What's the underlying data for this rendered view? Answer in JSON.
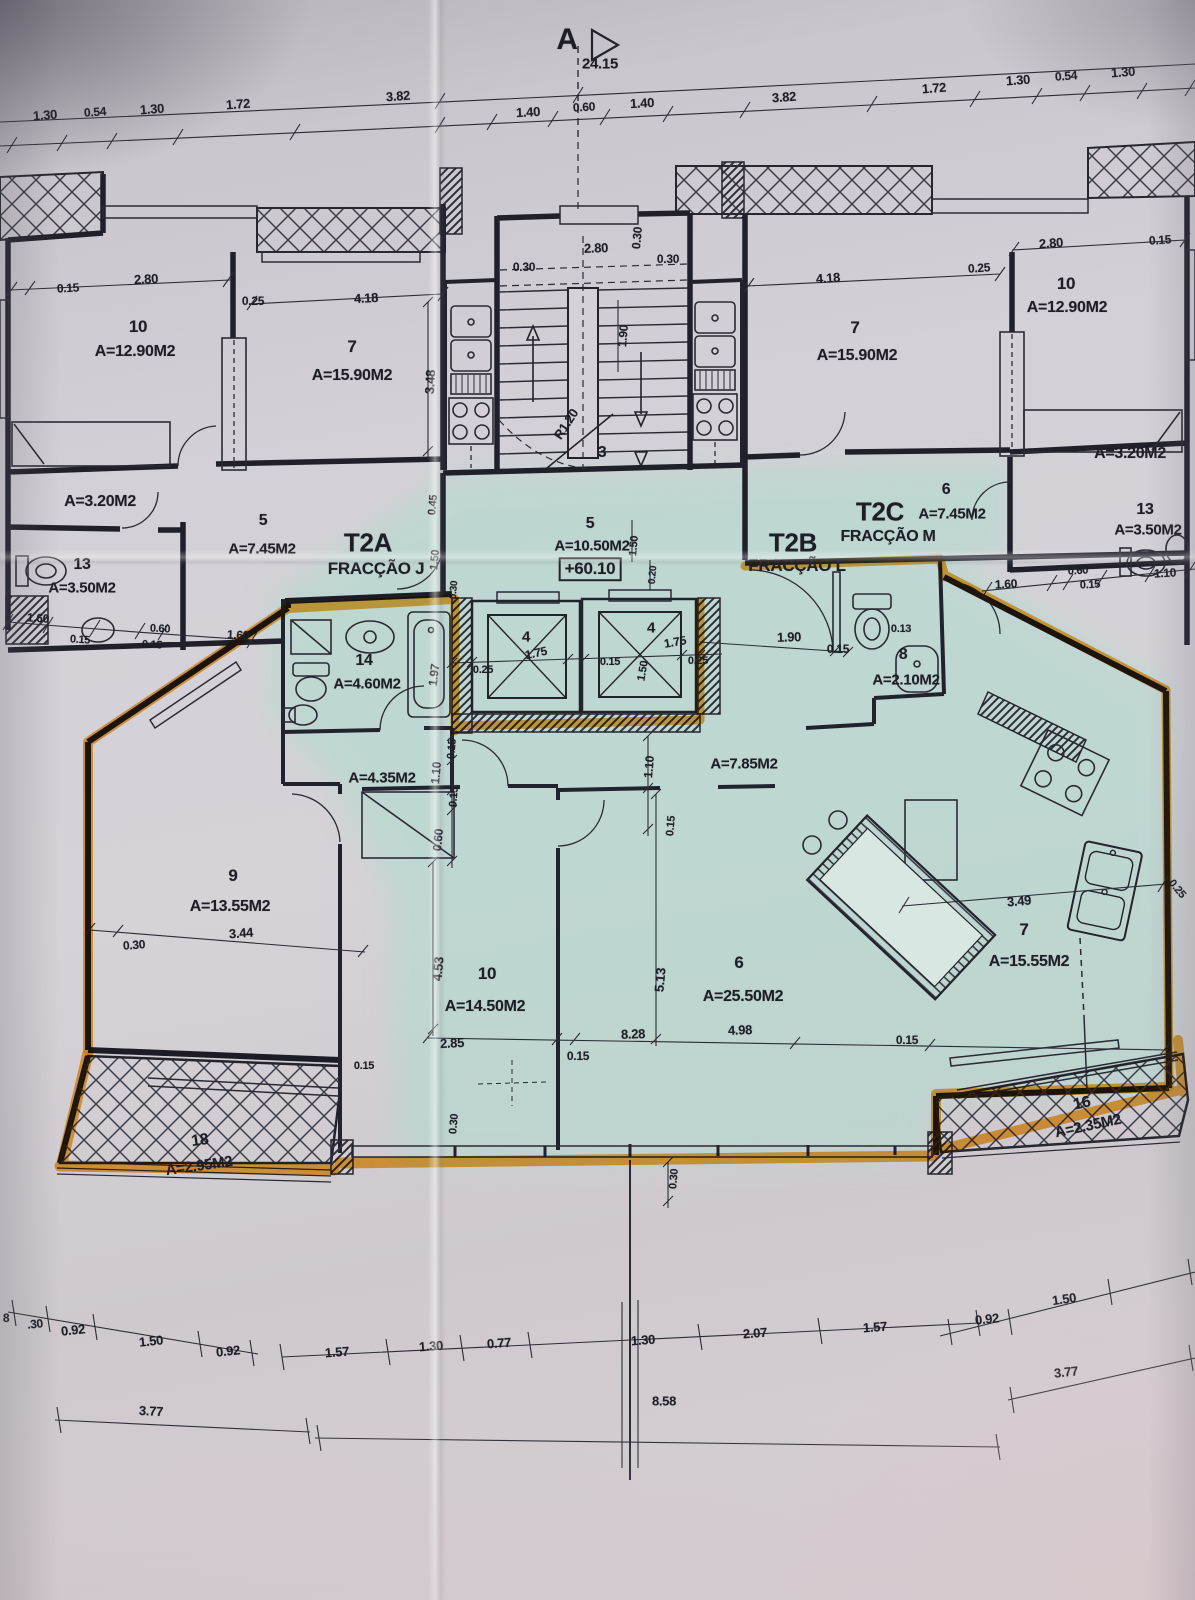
{
  "document": {
    "type": "architectural floor plan photo",
    "section_marker": "A",
    "section_overall_dim": "24.15",
    "floor_elevation": "+60.10",
    "stair_radius_note": "R1.20",
    "stair_room_number": "3"
  },
  "units": [
    {
      "code": "T2A",
      "fraction": "FRACÇÃO J",
      "highlighted": false
    },
    {
      "code": "T2B",
      "fraction": "FRACÇÃO L",
      "highlighted": true
    },
    {
      "code": "T2C",
      "fraction": "FRACÇÃO M",
      "highlighted": false
    }
  ],
  "colors": {
    "paper": "#d3d0d7",
    "highlight_tint": "#aedcce",
    "marker_orange": "#f59d16",
    "ink": "#1e1e27"
  },
  "labels": [
    {
      "n": "section-letter",
      "t": "A",
      "x": 567,
      "y": 40,
      "s": 30,
      "w": 700
    },
    {
      "n": "dim-label",
      "t": "24.15",
      "x": 600,
      "y": 64,
      "s": 15
    },
    {
      "n": "dim-label",
      "t": "1.30",
      "x": 45,
      "y": 115,
      "r": -4
    },
    {
      "n": "dim-label",
      "t": "0.54",
      "x": 95,
      "y": 112,
      "r": -4,
      "s": 12
    },
    {
      "n": "dim-label",
      "t": "1.30",
      "x": 152,
      "y": 109,
      "r": -4
    },
    {
      "n": "dim-label",
      "t": "1.72",
      "x": 238,
      "y": 104,
      "r": -4
    },
    {
      "n": "dim-label",
      "t": "3.82",
      "x": 398,
      "y": 96,
      "r": -4
    },
    {
      "n": "dim-label",
      "t": "1.40",
      "x": 528,
      "y": 112,
      "r": -3
    },
    {
      "n": "dim-label",
      "t": "0.60",
      "x": 584,
      "y": 107,
      "r": -3,
      "s": 12
    },
    {
      "n": "dim-label",
      "t": "1.40",
      "x": 642,
      "y": 103,
      "r": -3
    },
    {
      "n": "dim-label",
      "t": "3.82",
      "x": 784,
      "y": 97,
      "r": -4
    },
    {
      "n": "dim-label",
      "t": "1.72",
      "x": 934,
      "y": 88,
      "r": -4
    },
    {
      "n": "dim-label",
      "t": "1.30",
      "x": 1018,
      "y": 80,
      "r": -4
    },
    {
      "n": "dim-label",
      "t": "0.54",
      "x": 1066,
      "y": 76,
      "r": -4,
      "s": 12
    },
    {
      "n": "dim-label",
      "t": "1.30",
      "x": 1123,
      "y": 72,
      "r": -4
    },
    {
      "n": "dim-label",
      "t": "0.15",
      "x": 68,
      "y": 288,
      "r": -3,
      "s": 12
    },
    {
      "n": "dim-label",
      "t": "2.80",
      "x": 146,
      "y": 279,
      "r": -3
    },
    {
      "n": "room-number",
      "t": "10",
      "x": 138,
      "y": 327,
      "s": 17
    },
    {
      "n": "room-area",
      "t": "A=12.90M2",
      "x": 135,
      "y": 352,
      "s": 16
    },
    {
      "n": "dim-label",
      "t": "0.25",
      "x": 253,
      "y": 301,
      "s": 12
    },
    {
      "n": "dim-label",
      "t": "4.18",
      "x": 366,
      "y": 298,
      "r": -3
    },
    {
      "n": "room-number",
      "t": "7",
      "x": 352,
      "y": 347,
      "s": 17
    },
    {
      "n": "room-area",
      "t": "A=15.90M2",
      "x": 352,
      "y": 376,
      "s": 16
    },
    {
      "n": "dim-label",
      "t": "3.48",
      "x": 430,
      "y": 382,
      "r": -87
    },
    {
      "n": "dim-label",
      "t": "2.80",
      "x": 596,
      "y": 248,
      "r": -2
    },
    {
      "n": "dim-label",
      "t": "0.30",
      "x": 524,
      "y": 267,
      "s": 12
    },
    {
      "n": "dim-label",
      "t": "0.30",
      "x": 668,
      "y": 259,
      "s": 12
    },
    {
      "n": "dim-label",
      "t": "0.30",
      "x": 637,
      "y": 238,
      "r": -85,
      "s": 12
    },
    {
      "n": "dim-label",
      "t": "1.90",
      "x": 623,
      "y": 336,
      "r": -85,
      "s": 12
    },
    {
      "n": "stair-radius",
      "t": "R1.20",
      "x": 566,
      "y": 424,
      "r": -57,
      "s": 13
    },
    {
      "n": "stair-number",
      "t": "3",
      "x": 602,
      "y": 453,
      "s": 16
    },
    {
      "n": "dim-label",
      "t": "4.18",
      "x": 828,
      "y": 278,
      "r": -4
    },
    {
      "n": "room-number",
      "t": "7",
      "x": 855,
      "y": 328,
      "s": 17
    },
    {
      "n": "room-area",
      "t": "A=15.90M2",
      "x": 857,
      "y": 356,
      "s": 16
    },
    {
      "n": "dim-label",
      "t": "0.25",
      "x": 979,
      "y": 268,
      "r": -4,
      "s": 12
    },
    {
      "n": "dim-label",
      "t": "2.80",
      "x": 1051,
      "y": 243,
      "r": -4
    },
    {
      "n": "room-number",
      "t": "10",
      "x": 1066,
      "y": 284,
      "s": 17
    },
    {
      "n": "room-area",
      "t": "A=12.90M2",
      "x": 1067,
      "y": 308,
      "s": 16
    },
    {
      "n": "dim-label",
      "t": "0.15",
      "x": 1160,
      "y": 240,
      "r": -4,
      "s": 12
    },
    {
      "n": "room-area",
      "t": "A=3.20M2",
      "x": 100,
      "y": 502,
      "s": 16
    },
    {
      "n": "room-number",
      "t": "5",
      "x": 263,
      "y": 521,
      "s": 16
    },
    {
      "n": "room-area",
      "t": "A=7.45M2",
      "x": 262,
      "y": 549,
      "s": 15
    },
    {
      "n": "room-number",
      "t": "13",
      "x": 82,
      "y": 565,
      "s": 16
    },
    {
      "n": "room-area",
      "t": "A=3.50M2",
      "x": 82,
      "y": 588,
      "s": 15
    },
    {
      "n": "dim-label",
      "t": "1.60",
      "x": 38,
      "y": 618,
      "r": 4,
      "s": 12
    },
    {
      "n": "dim-label",
      "t": "0.15",
      "x": 80,
      "y": 640,
      "r": 4,
      "s": 11
    },
    {
      "n": "dim-label",
      "t": "0.60",
      "x": 160,
      "y": 629,
      "r": 3,
      "s": 11
    },
    {
      "n": "dim-label",
      "t": "0.15",
      "x": 152,
      "y": 645,
      "r": 3,
      "s": 11
    },
    {
      "n": "dim-label",
      "t": "1.60",
      "x": 238,
      "y": 635,
      "r": 3,
      "s": 12
    },
    {
      "n": "unit-code-t2a",
      "t": "T2A",
      "x": 368,
      "y": 543,
      "s": 26,
      "w": 700
    },
    {
      "n": "unit-fraction-j",
      "t": "FRACÇÃO J",
      "x": 376,
      "y": 569,
      "s": 17
    },
    {
      "n": "dim-label",
      "t": "0.45",
      "x": 433,
      "y": 505,
      "r": -85,
      "s": 11
    },
    {
      "n": "dim-label",
      "t": "1.50",
      "x": 435,
      "y": 560,
      "r": -85,
      "s": 11
    },
    {
      "n": "dim-label",
      "t": "0.30",
      "x": 454,
      "y": 590,
      "r": -85,
      "s": 10
    },
    {
      "n": "room-number",
      "t": "5",
      "x": 590,
      "y": 524,
      "s": 16
    },
    {
      "n": "room-area",
      "t": "A=10.50M2",
      "x": 592,
      "y": 546,
      "s": 15
    },
    {
      "n": "elevation-label",
      "t": "+60.10",
      "x": 590,
      "y": 569,
      "s": 17,
      "w": 700,
      "box": true
    },
    {
      "n": "dim-label",
      "t": "1.50",
      "x": 634,
      "y": 546,
      "r": -85,
      "s": 11
    },
    {
      "n": "dim-label",
      "t": "0.20",
      "x": 653,
      "y": 575,
      "r": -85,
      "s": 10
    },
    {
      "n": "unit-code-t2b",
      "t": "T2B",
      "x": 793,
      "y": 543,
      "s": 26,
      "w": 700
    },
    {
      "n": "unit-fraction-l",
      "t": "FRACÇÃO L",
      "x": 797,
      "y": 566,
      "s": 17
    },
    {
      "n": "unit-code-t2c",
      "t": "T2C",
      "x": 880,
      "y": 512,
      "s": 26,
      "w": 700
    },
    {
      "n": "unit-fraction-m",
      "t": "FRACÇÃO M",
      "x": 888,
      "y": 537,
      "s": 16
    },
    {
      "n": "room-number",
      "t": "6",
      "x": 946,
      "y": 490,
      "s": 16
    },
    {
      "n": "room-area",
      "t": "A=7.45M2",
      "x": 952,
      "y": 514,
      "s": 15
    },
    {
      "n": "room-area",
      "t": "A=3.20M2",
      "x": 1130,
      "y": 454,
      "s": 16
    },
    {
      "n": "room-number",
      "t": "13",
      "x": 1145,
      "y": 510,
      "s": 16
    },
    {
      "n": "room-area",
      "t": "A=3.50M2",
      "x": 1148,
      "y": 530,
      "s": 15
    },
    {
      "n": "dim-label",
      "t": "1.60",
      "x": 1006,
      "y": 584,
      "r": -3,
      "s": 12
    },
    {
      "n": "dim-label",
      "t": "0.60",
      "x": 1078,
      "y": 571,
      "r": -3,
      "s": 11
    },
    {
      "n": "dim-label",
      "t": "0.15",
      "x": 1090,
      "y": 585,
      "r": -3,
      "s": 11
    },
    {
      "n": "dim-label",
      "t": "1.10",
      "x": 1165,
      "y": 573,
      "r": -3,
      "s": 12
    },
    {
      "n": "elevator-number",
      "t": "4",
      "x": 526,
      "y": 637,
      "s": 15
    },
    {
      "n": "dim-label",
      "t": "1.75",
      "x": 536,
      "y": 653,
      "r": -12,
      "s": 12
    },
    {
      "n": "dim-label",
      "t": "0.25",
      "x": 483,
      "y": 670,
      "s": 11
    },
    {
      "n": "elevator-number",
      "t": "4",
      "x": 651,
      "y": 628,
      "s": 15
    },
    {
      "n": "dim-label",
      "t": "1.75",
      "x": 675,
      "y": 642,
      "r": -10,
      "s": 12
    },
    {
      "n": "dim-label",
      "t": "0.15",
      "x": 610,
      "y": 662,
      "s": 11
    },
    {
      "n": "dim-label",
      "t": "1.50",
      "x": 643,
      "y": 671,
      "r": -80,
      "s": 11
    },
    {
      "n": "dim-label",
      "t": "0.25",
      "x": 698,
      "y": 661,
      "s": 11
    },
    {
      "n": "room-number",
      "t": "14",
      "x": 364,
      "y": 661,
      "s": 16
    },
    {
      "n": "room-area",
      "t": "A=4.60M2",
      "x": 367,
      "y": 684,
      "s": 15
    },
    {
      "n": "dim-label",
      "t": "1.97",
      "x": 434,
      "y": 675,
      "r": -83,
      "s": 12
    },
    {
      "n": "dim-label",
      "t": "1.90",
      "x": 789,
      "y": 637,
      "r": -2,
      "s": 13
    },
    {
      "n": "dim-label",
      "t": "0.15",
      "x": 838,
      "y": 649,
      "s": 12
    },
    {
      "n": "dim-label",
      "t": "0.13",
      "x": 901,
      "y": 629,
      "s": 11
    },
    {
      "n": "room-number",
      "t": "8",
      "x": 903,
      "y": 655,
      "s": 16
    },
    {
      "n": "room-area",
      "t": "A=2.10M2",
      "x": 906,
      "y": 680,
      "s": 15
    },
    {
      "n": "room-area",
      "t": "A=4.35M2",
      "x": 382,
      "y": 778,
      "s": 15
    },
    {
      "n": "dim-label",
      "t": "0.15",
      "x": 452,
      "y": 749,
      "r": -85,
      "s": 11
    },
    {
      "n": "dim-label",
      "t": "1.10",
      "x": 436,
      "y": 773,
      "r": -85,
      "s": 12
    },
    {
      "n": "dim-label",
      "t": "0.15",
      "x": 454,
      "y": 797,
      "r": -85,
      "s": 11
    },
    {
      "n": "dim-label",
      "t": "0.60",
      "x": 438,
      "y": 840,
      "r": -85,
      "s": 12
    },
    {
      "n": "dim-label",
      "t": "1.10",
      "x": 649,
      "y": 767,
      "r": -85,
      "s": 12
    },
    {
      "n": "room-area",
      "t": "A=7.85M2",
      "x": 744,
      "y": 764,
      "s": 15
    },
    {
      "n": "dim-label",
      "t": "0.15",
      "x": 671,
      "y": 826,
      "r": -85,
      "s": 11
    },
    {
      "n": "room-number",
      "t": "9",
      "x": 233,
      "y": 876,
      "s": 17
    },
    {
      "n": "room-area",
      "t": "A=13.55M2",
      "x": 230,
      "y": 907,
      "s": 16
    },
    {
      "n": "dim-label",
      "t": "3.44",
      "x": 241,
      "y": 933,
      "r": -4,
      "s": 13
    },
    {
      "n": "dim-label",
      "t": "0.30",
      "x": 134,
      "y": 945,
      "r": -4,
      "s": 12
    },
    {
      "n": "dim-label",
      "t": "4.53",
      "x": 438,
      "y": 969,
      "r": -85,
      "s": 13
    },
    {
      "n": "room-number",
      "t": "10",
      "x": 487,
      "y": 974,
      "s": 17
    },
    {
      "n": "room-area",
      "t": "A=14.50M2",
      "x": 485,
      "y": 1007,
      "s": 16
    },
    {
      "n": "dim-label",
      "t": "2.85",
      "x": 452,
      "y": 1043,
      "r": -3,
      "s": 13
    },
    {
      "n": "dim-label",
      "t": "0.15",
      "x": 578,
      "y": 1056,
      "s": 12
    },
    {
      "n": "dim-label",
      "t": "8.28",
      "x": 633,
      "y": 1034,
      "r": -2,
      "s": 13
    },
    {
      "n": "dim-label",
      "t": "5.13",
      "x": 660,
      "y": 980,
      "r": -85,
      "s": 13
    },
    {
      "n": "room-number",
      "t": "6",
      "x": 739,
      "y": 963,
      "s": 17
    },
    {
      "n": "room-area",
      "t": "A=25.50M2",
      "x": 743,
      "y": 997,
      "s": 16
    },
    {
      "n": "dim-label",
      "t": "4.98",
      "x": 740,
      "y": 1030,
      "r": -2,
      "s": 13
    },
    {
      "n": "dim-label",
      "t": "3.49",
      "x": 1019,
      "y": 901,
      "r": -5,
      "s": 13
    },
    {
      "n": "room-number",
      "t": "7",
      "x": 1024,
      "y": 930,
      "s": 17
    },
    {
      "n": "room-area",
      "t": "A=15.55M2",
      "x": 1029,
      "y": 962,
      "s": 16
    },
    {
      "n": "dim-label",
      "t": "0.15",
      "x": 907,
      "y": 1040,
      "s": 12
    },
    {
      "n": "dim-label",
      "t": "0.25",
      "x": 1177,
      "y": 889,
      "r": 50,
      "s": 11
    },
    {
      "n": "room-number",
      "t": "18",
      "x": 200,
      "y": 1141,
      "s": 16,
      "r": -8
    },
    {
      "n": "room-area",
      "t": "A=2.95M2",
      "x": 199,
      "y": 1166,
      "s": 15,
      "r": -8
    },
    {
      "n": "room-number",
      "t": "16",
      "x": 1082,
      "y": 1104,
      "s": 16,
      "r": -12
    },
    {
      "n": "room-area",
      "t": "A=2.35M2",
      "x": 1088,
      "y": 1126,
      "s": 15,
      "r": -12
    },
    {
      "n": "dim-label",
      "t": "0.15",
      "x": 364,
      "y": 1066,
      "s": 11
    },
    {
      "n": "dim-label",
      "t": "0.30",
      "x": 454,
      "y": 1124,
      "r": -85,
      "s": 11
    },
    {
      "n": "dim-label",
      "t": "0.30",
      "x": 674,
      "y": 1179,
      "r": -85,
      "s": 11
    },
    {
      "n": "dim-label",
      "t": "8",
      "x": 6,
      "y": 1318,
      "s": 12
    },
    {
      "n": "dim-label",
      "t": ".30",
      "x": 35,
      "y": 1324,
      "s": 12,
      "r": -6
    },
    {
      "n": "dim-label",
      "t": "0.92",
      "x": 73,
      "y": 1330,
      "r": -6,
      "s": 13
    },
    {
      "n": "dim-label",
      "t": "1.50",
      "x": 151,
      "y": 1341,
      "r": -6,
      "s": 13
    },
    {
      "n": "dim-label",
      "t": "0.92",
      "x": 228,
      "y": 1351,
      "r": -6,
      "s": 13
    },
    {
      "n": "dim-label",
      "t": "1.57",
      "x": 337,
      "y": 1352,
      "r": -4,
      "s": 13
    },
    {
      "n": "dim-label",
      "t": "1.30",
      "x": 431,
      "y": 1346,
      "r": -4,
      "s": 13
    },
    {
      "n": "dim-label",
      "t": "0.77",
      "x": 499,
      "y": 1343,
      "r": -4,
      "s": 13
    },
    {
      "n": "dim-label",
      "t": "1.30",
      "x": 643,
      "y": 1340,
      "r": -4,
      "s": 13
    },
    {
      "n": "dim-label",
      "t": "2.07",
      "x": 755,
      "y": 1333,
      "r": -4,
      "s": 13
    },
    {
      "n": "dim-label",
      "t": "1.57",
      "x": 875,
      "y": 1327,
      "r": -4,
      "s": 13
    },
    {
      "n": "dim-label",
      "t": "0.92",
      "x": 987,
      "y": 1319,
      "r": -6,
      "s": 13
    },
    {
      "n": "dim-label",
      "t": "1.50",
      "x": 1064,
      "y": 1299,
      "r": -8,
      "s": 13
    },
    {
      "n": "dim-label",
      "t": "3.77",
      "x": 151,
      "y": 1411,
      "r": 3,
      "s": 13
    },
    {
      "n": "dim-label",
      "t": "8.58",
      "x": 664,
      "y": 1401,
      "s": 13
    },
    {
      "n": "dim-label",
      "t": "3.77",
      "x": 1066,
      "y": 1372,
      "r": -6,
      "s": 13
    }
  ]
}
